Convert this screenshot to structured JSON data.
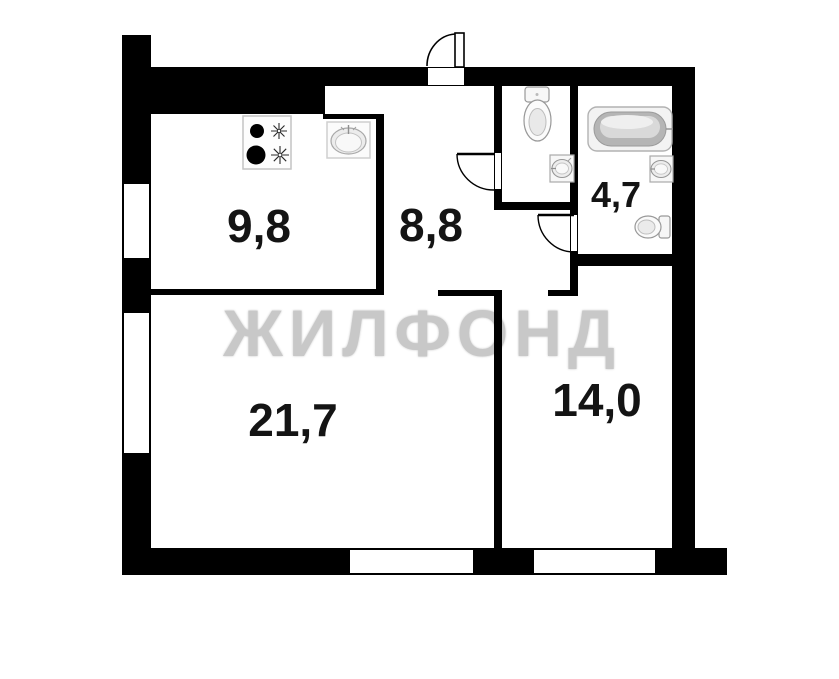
{
  "plan": {
    "title": "apartment floor plan",
    "watermark": "ЖИЛФОНД",
    "rooms": {
      "kitchen": {
        "area": "9,8"
      },
      "hallway": {
        "area": "8,8"
      },
      "bathroom": {
        "area": "4,7"
      },
      "living_room": {
        "area": "21,7"
      },
      "bedroom": {
        "area": "14,0"
      }
    },
    "colors": {
      "wall": "#000000",
      "background": "#ffffff",
      "watermark": "#c8c8c8",
      "label": "#141414",
      "fixture_outline": "#9a9a9a"
    },
    "icons": [
      "entrance-door-icon",
      "wc-door-icon",
      "bathroom-door-icon",
      "stove-icon",
      "kitchen-sink-icon",
      "toilet-icon",
      "washbasin-icon",
      "bathtub-icon",
      "toilet-side-icon"
    ]
  }
}
